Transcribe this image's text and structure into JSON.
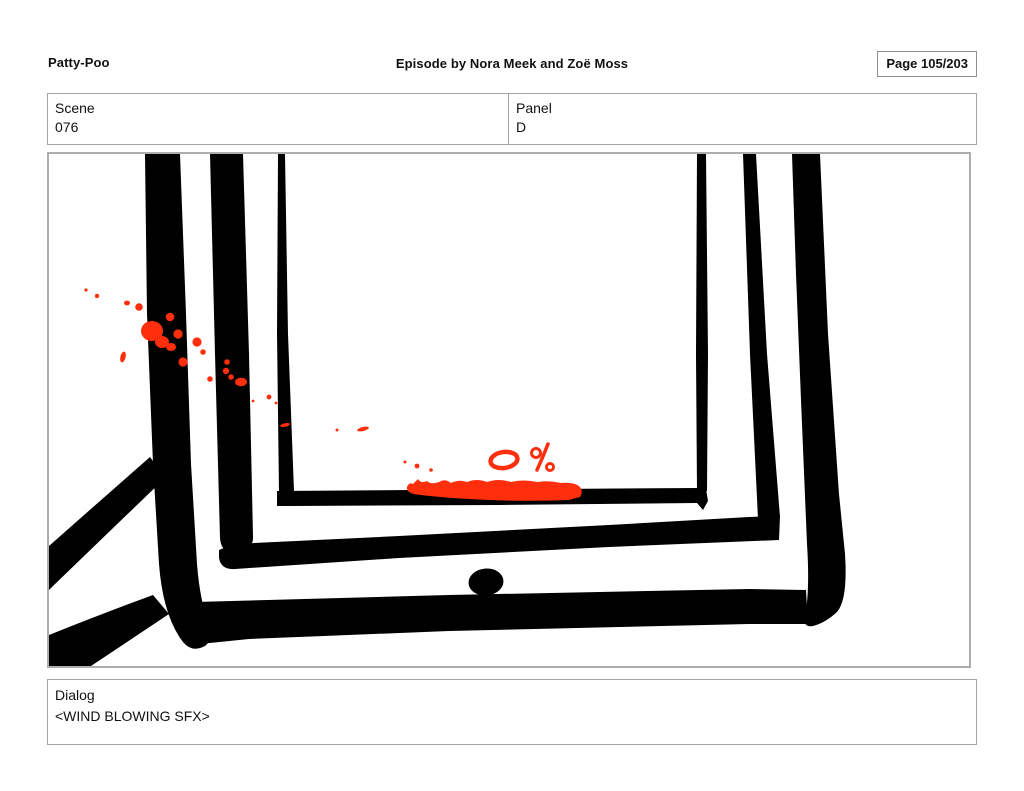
{
  "header": {
    "title": "Patty-Poo",
    "episode": "Episode by Nora Meek and Zoë Moss",
    "page_label": "Page 105/203"
  },
  "meta": {
    "scene_label": "Scene",
    "scene_value": "076",
    "panel_label": "Panel",
    "panel_value": "D"
  },
  "artwork": {
    "type": "storyboard-panel-drawing",
    "description": "Hand-inked close-up of a tablet with nested heavy black frame outlines, red blood splatter across the upper left, a red smear along the bottom of the screen beside a hand-drawn battery reading, two diagonal ink strokes at the lower left, and an oval home button",
    "battery_text": "0%",
    "ink_color": "#000000",
    "splatter_color": "#ff2e0d"
  },
  "dialog": {
    "label": "Dialog",
    "value": "<WIND BLOWING SFX>"
  }
}
